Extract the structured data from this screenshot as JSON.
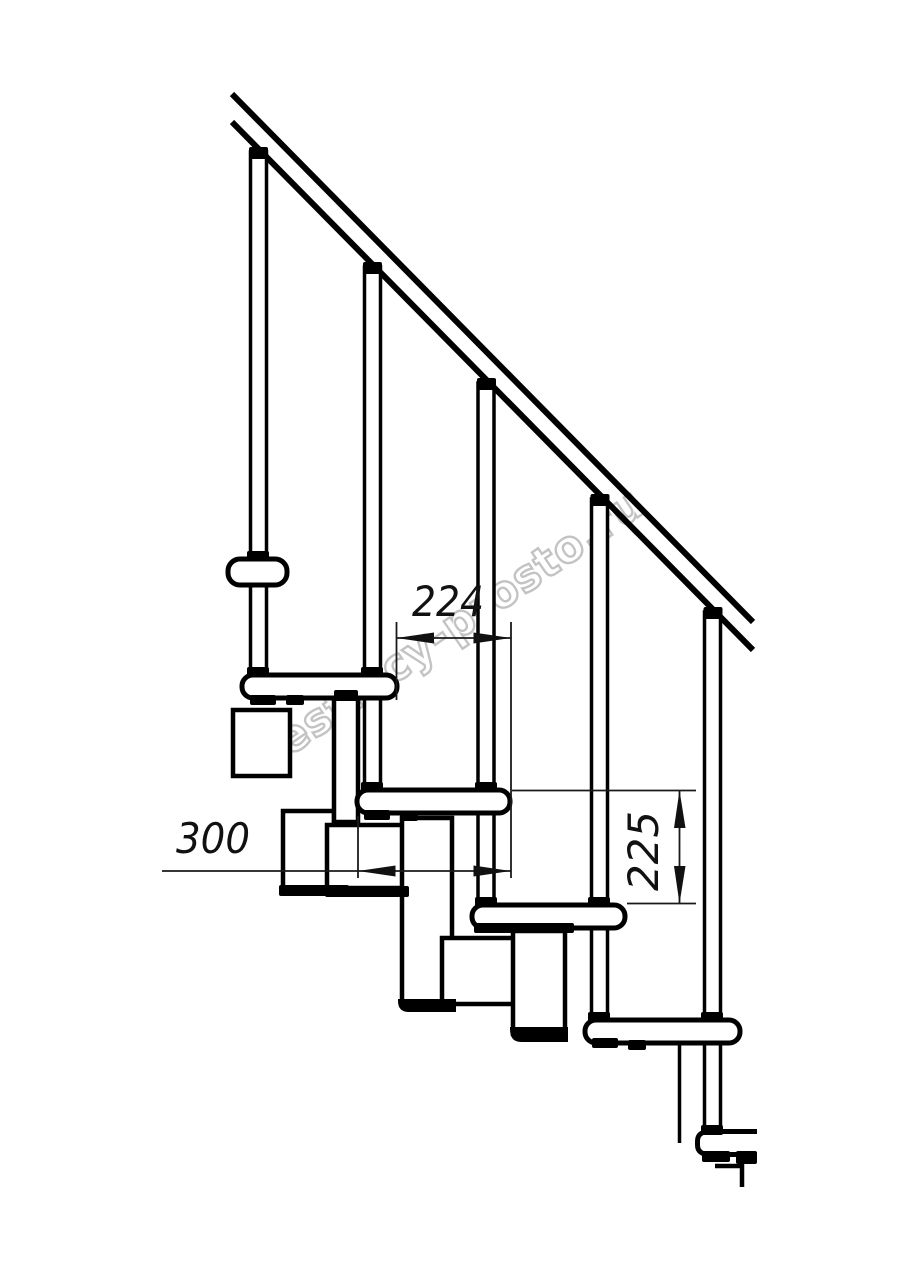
{
  "meta": {
    "type": "technical-drawing",
    "subject": "modular staircase side elevation"
  },
  "colors": {
    "background": "#ffffff",
    "line": "#000000",
    "watermark": "#c3c3c3"
  },
  "watermark": {
    "text": "lestnicy-prosto.ru"
  },
  "dimensions": {
    "step_offset": {
      "value": "224",
      "unit": "mm",
      "orientation": "horizontal"
    },
    "tread_depth": {
      "value": "300",
      "unit": "mm",
      "orientation": "horizontal"
    },
    "riser_height": {
      "value": "225",
      "unit": "mm",
      "orientation": "vertical"
    }
  },
  "structure": {
    "balusters": 5,
    "treads": 5,
    "handrail": true,
    "landing_tread": 1
  }
}
